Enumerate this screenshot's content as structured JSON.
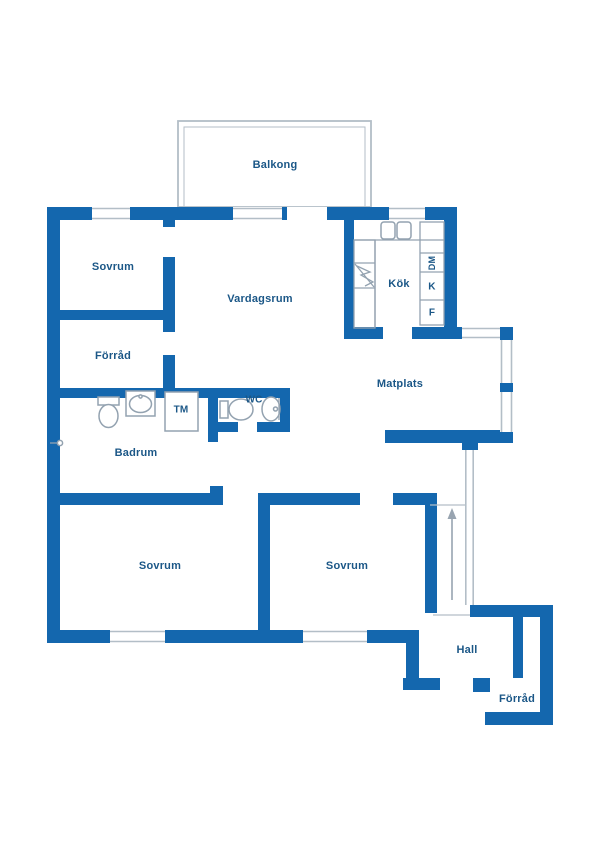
{
  "plan": {
    "title": "Apartment floor plan",
    "colors": {
      "wall": "#1467ae",
      "label": "#1b5787",
      "fixture": "#93a2b0",
      "window_line": "#b3bec7",
      "arrow": "#98a4b0",
      "bg": "#ffffff"
    },
    "labels": [
      {
        "id": "balkong",
        "kind": "room",
        "label": "Balkong",
        "x": 275,
        "y": 165,
        "fs": 11
      },
      {
        "id": "sovrum-nw",
        "kind": "room",
        "label": "Sovrum",
        "x": 113,
        "y": 267,
        "fs": 11
      },
      {
        "id": "vardagsrum",
        "kind": "room",
        "label": "Vardagsrum",
        "x": 260,
        "y": 299,
        "fs": 11
      },
      {
        "id": "forrad-w",
        "kind": "room",
        "label": "Förråd",
        "x": 113,
        "y": 356,
        "fs": 11
      },
      {
        "id": "kok",
        "kind": "room",
        "label": "Kök",
        "x": 399,
        "y": 284,
        "fs": 11
      },
      {
        "id": "matplats",
        "kind": "room",
        "label": "Matplats",
        "x": 400,
        "y": 384,
        "fs": 11
      },
      {
        "id": "wc",
        "kind": "room",
        "label": "WC",
        "x": 254,
        "y": 400,
        "fs": 10
      },
      {
        "id": "badrum",
        "kind": "room",
        "label": "Badrum",
        "x": 136,
        "y": 453,
        "fs": 11
      },
      {
        "id": "sovrum-sw",
        "kind": "room",
        "label": "Sovrum",
        "x": 160,
        "y": 566,
        "fs": 11
      },
      {
        "id": "sovrum-se",
        "kind": "room",
        "label": "Sovrum",
        "x": 347,
        "y": 566,
        "fs": 11
      },
      {
        "id": "hall",
        "kind": "room",
        "label": "Hall",
        "x": 467,
        "y": 650,
        "fs": 11
      },
      {
        "id": "forrad-se",
        "kind": "room",
        "label": "Förråd",
        "x": 517,
        "y": 699,
        "fs": 11
      },
      {
        "id": "tm",
        "kind": "appliance",
        "label": "TM",
        "x": 181,
        "y": 410,
        "fs": 10
      },
      {
        "id": "dm",
        "kind": "appliance",
        "label": "DM",
        "x": 432,
        "y": 263,
        "fs": 9,
        "rot": true
      },
      {
        "id": "kyl",
        "kind": "appliance",
        "label": "K",
        "x": 432,
        "y": 287,
        "fs": 10
      },
      {
        "id": "frys",
        "kind": "appliance",
        "label": "F",
        "x": 432,
        "y": 313,
        "fs": 10
      }
    ],
    "legend": {
      "arrow_meaning": "entrance direction"
    }
  }
}
